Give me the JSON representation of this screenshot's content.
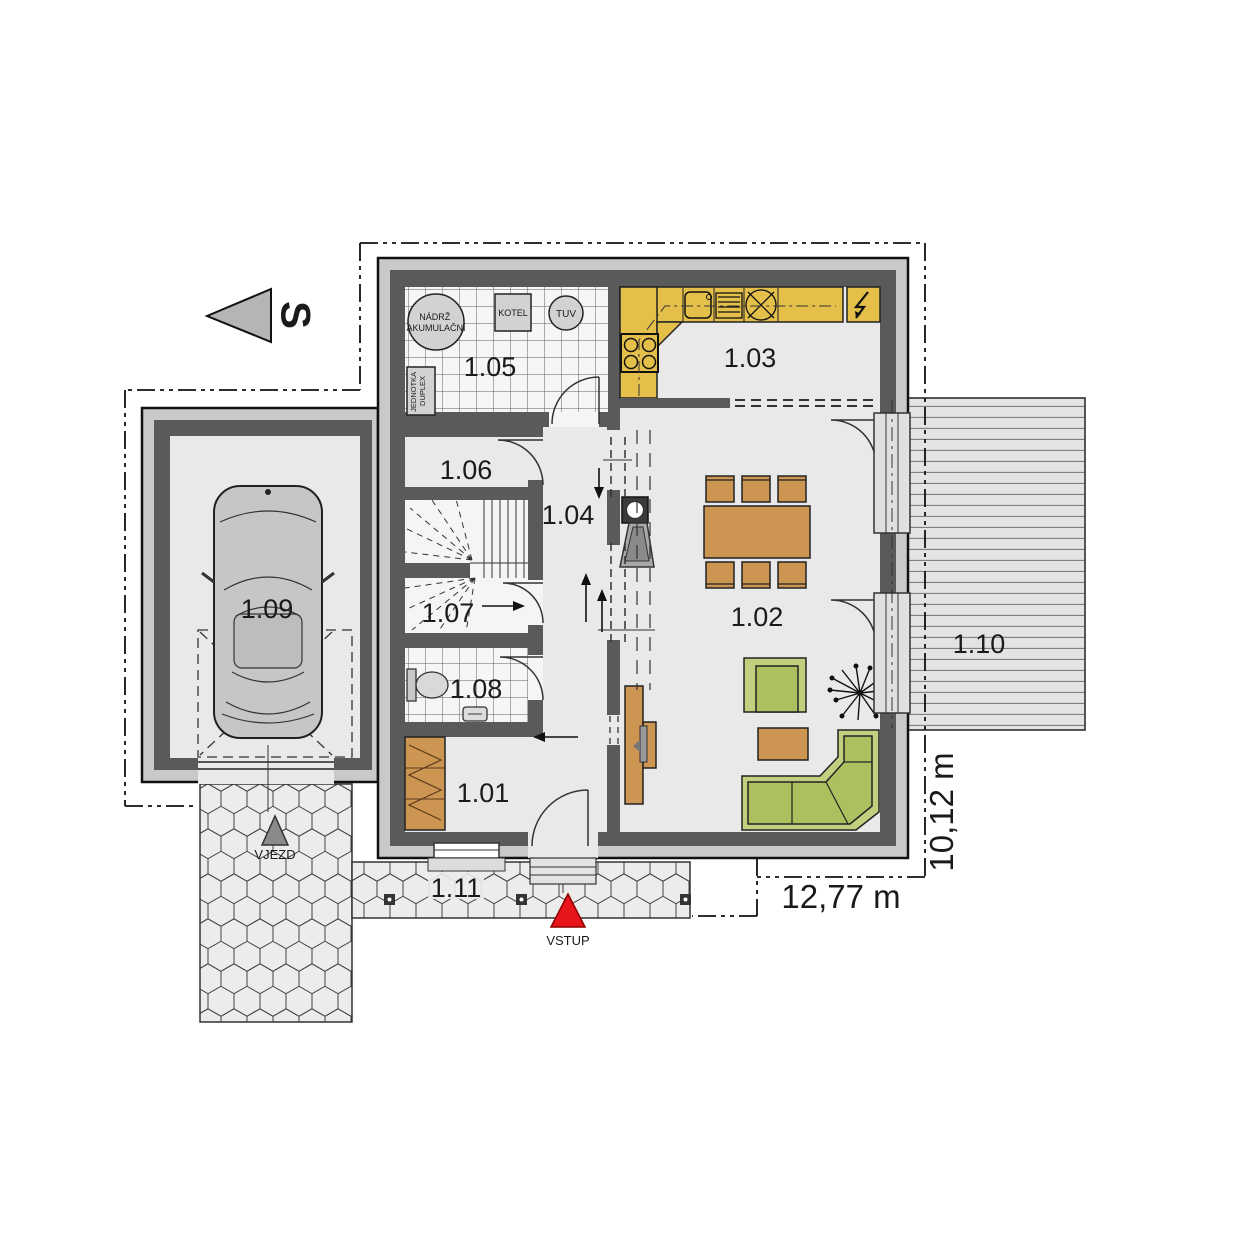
{
  "compass": {
    "north_label": "S"
  },
  "dimensions": {
    "width_label": "12,77 m",
    "height_label": "10,12 m"
  },
  "markers": {
    "entrance_label": "VSTUP",
    "driveway_label": "VJEZD"
  },
  "rooms": {
    "r101": "1.01",
    "r102": "1.02",
    "r103": "1.03",
    "r104": "1.04",
    "r105": "1.05",
    "r106": "1.06",
    "r107": "1.07",
    "r108": "1.08",
    "r109": "1.09",
    "r110": "1.10",
    "r111": "1.11"
  },
  "equipment": {
    "tank_line1": "NÁDRŽ",
    "tank_line2": "AKUMULAČNÍ",
    "boiler": "KOTEL",
    "hot_water": "TUV",
    "unit_line1": "JEDNOTKA",
    "unit_line2": "DUPLEX"
  },
  "colors": {
    "wall": "#5a5a5a",
    "outer_band": "#c9c9c9",
    "floor": "#e9e9e9",
    "kitchen_counter": "#e4bf4a",
    "wood_furniture": "#cd9552",
    "sofa_green": "#adc060",
    "sofa_green_light": "#c2cf7e",
    "entry_red": "#e8151c"
  }
}
